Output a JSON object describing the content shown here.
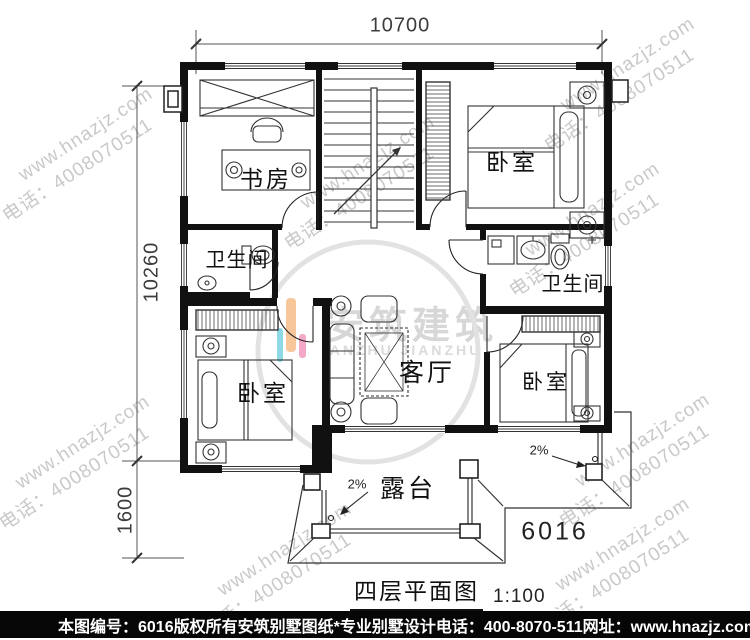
{
  "watermark": {
    "line1": "www.hnazjz.com",
    "line2": "电话：4008070511"
  },
  "logo": {
    "name_cn": "安筑建筑",
    "name_en": "ANZHU JIANZHU",
    "bar_cyan": "#8fd9e6",
    "bar_orange": "#f7c69b",
    "bar_pink": "#f2a8c6"
  },
  "dimensions": {
    "top_width": "10700",
    "left_height": "10260",
    "terrace_depth": "1600"
  },
  "rooms": {
    "study": "书房",
    "bedroom_top_right": "卧室",
    "bath_left": "卫生间",
    "bath_right": "卫生间",
    "living": "客厅",
    "bedroom_bottom_left": "卧室",
    "bedroom_bottom_right": "卧室",
    "terrace": "露台"
  },
  "annotations": {
    "slope_left": "2%",
    "slope_right": "2%",
    "plan_number": "6016"
  },
  "title": {
    "text": "四层平面图",
    "scale": "1:100"
  },
  "footer": {
    "item_no": "本图编号：6016",
    "copyright": "版权所有",
    "company": "安筑别墅图纸*专业别墅设计",
    "phone": "电话：400-8070-511",
    "website": "网址：www.hnazjz.com"
  }
}
